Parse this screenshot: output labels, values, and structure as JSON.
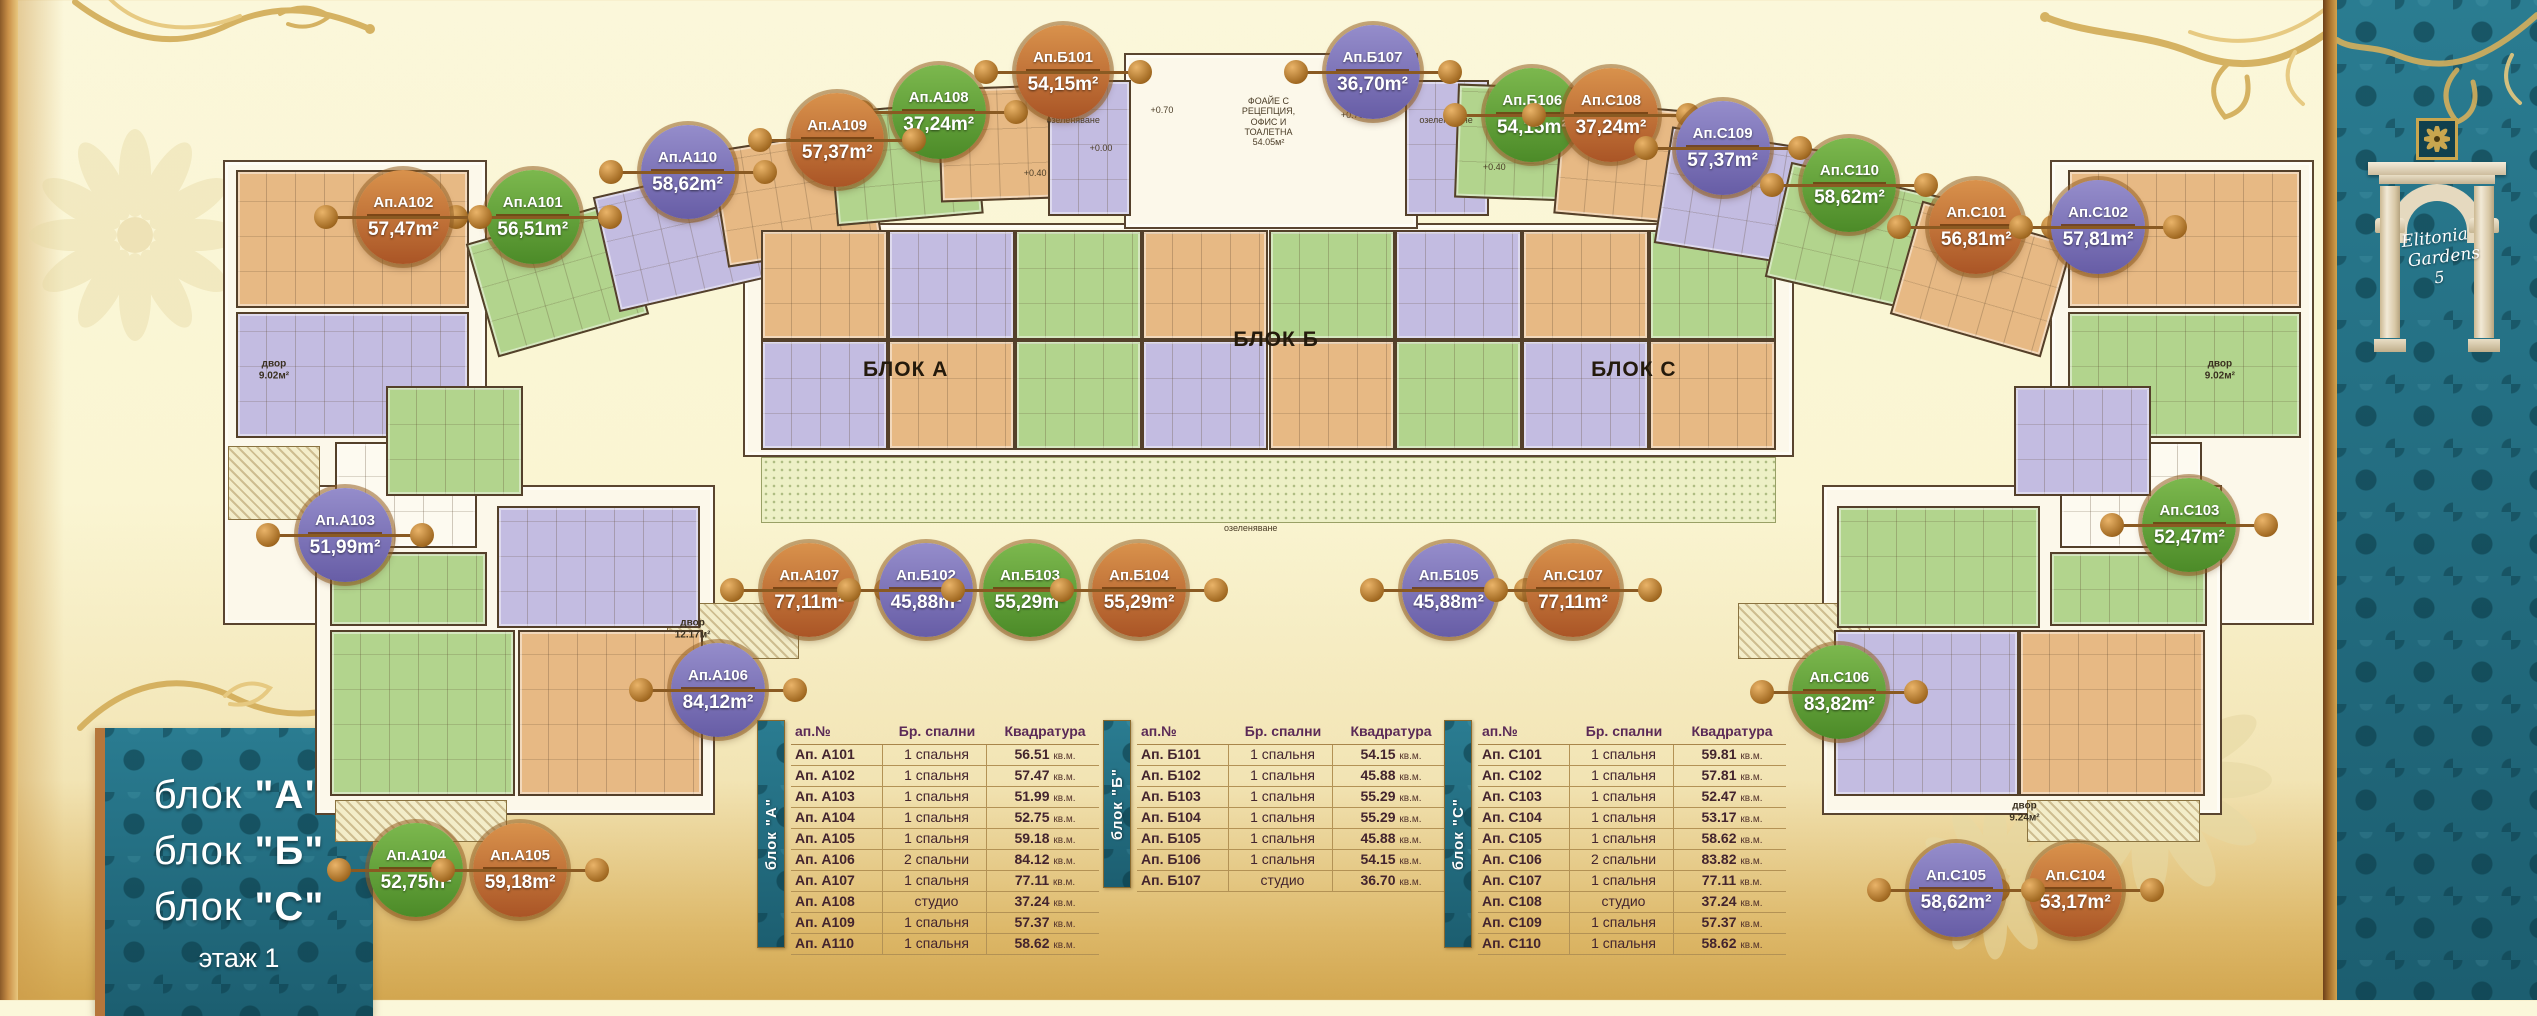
{
  "title_panel": {
    "lines": [
      {
        "prefix": "блок ",
        "letter": "\"А\""
      },
      {
        "prefix": "блок ",
        "letter": "\"Б\""
      },
      {
        "prefix": "блок ",
        "letter": "\"С\""
      }
    ],
    "floor": "этаж 1"
  },
  "brand": {
    "line1": "Elitonia",
    "line2": "Gardens",
    "number": "5"
  },
  "colors": {
    "teal": "#226f83",
    "gold": "#d4af5c",
    "cream": "#fbf7da",
    "badge_orange": "#c4702f",
    "badge_green": "#5f9a35",
    "badge_purple": "#7d74b5"
  },
  "plan": {
    "bases": [
      [
        8.8,
        16.0,
        10.4,
        46.5
      ],
      [
        12.4,
        48.5,
        15.8,
        33.0
      ],
      [
        29.3,
        22.3,
        41.4,
        23.4
      ],
      [
        44.3,
        5.3,
        11.6,
        17.6
      ],
      [
        80.8,
        16.0,
        10.4,
        46.5
      ],
      [
        71.8,
        48.5,
        15.8,
        33.0
      ]
    ],
    "cells": [
      [
        9.3,
        17.0,
        9.2,
        13.8,
        "orange",
        0
      ],
      [
        9.3,
        31.2,
        9.2,
        12.6,
        "purple",
        0
      ],
      [
        13.2,
        44.2,
        5.6,
        10.6,
        "white",
        0
      ],
      [
        13.0,
        55.2,
        6.2,
        7.4,
        "green",
        0
      ],
      [
        13.0,
        63.0,
        7.3,
        16.6,
        "green",
        0
      ],
      [
        20.4,
        63.0,
        7.3,
        16.6,
        "orange",
        0
      ],
      [
        19.6,
        50.6,
        8.0,
        12.2,
        "purple",
        0
      ],
      [
        15.2,
        38.6,
        5.4,
        11.0,
        "green",
        0
      ],
      [
        18.9,
        22.0,
        6.2,
        11.8,
        "green",
        -16
      ],
      [
        23.8,
        17.8,
        6.2,
        11.8,
        "purple",
        -13
      ],
      [
        28.3,
        13.8,
        6.2,
        11.8,
        "orange",
        -9
      ],
      [
        32.8,
        10.6,
        5.8,
        11.4,
        "green",
        -5
      ],
      [
        37.0,
        8.6,
        5.6,
        11.4,
        "orange",
        -2
      ],
      [
        41.3,
        8.0,
        3.3,
        13.6,
        "purple",
        0
      ],
      [
        55.4,
        8.0,
        3.3,
        13.6,
        "purple",
        0
      ],
      [
        30.0,
        23.0,
        5.0,
        11.0,
        "orange",
        0
      ],
      [
        35.0,
        23.0,
        5.0,
        11.0,
        "purple",
        0
      ],
      [
        40.0,
        23.0,
        5.0,
        11.0,
        "green",
        0
      ],
      [
        45.0,
        23.0,
        5.0,
        11.0,
        "orange",
        0
      ],
      [
        50.0,
        23.0,
        5.0,
        11.0,
        "green",
        0
      ],
      [
        55.0,
        23.0,
        5.0,
        11.0,
        "purple",
        0
      ],
      [
        60.0,
        23.0,
        5.0,
        11.0,
        "orange",
        0
      ],
      [
        65.0,
        23.0,
        5.0,
        11.0,
        "green",
        0
      ],
      [
        30.0,
        34.0,
        5.0,
        11.0,
        "purple",
        0
      ],
      [
        35.0,
        34.0,
        5.0,
        11.0,
        "orange",
        0
      ],
      [
        40.0,
        34.0,
        5.0,
        11.0,
        "green",
        0
      ],
      [
        45.0,
        34.0,
        5.0,
        11.0,
        "purple",
        0
      ],
      [
        50.0,
        34.0,
        5.0,
        11.0,
        "orange",
        0
      ],
      [
        55.0,
        34.0,
        5.0,
        11.0,
        "green",
        0
      ],
      [
        60.0,
        34.0,
        5.0,
        11.0,
        "purple",
        0
      ],
      [
        65.0,
        34.0,
        5.0,
        11.0,
        "orange",
        0
      ],
      [
        57.4,
        8.6,
        5.6,
        11.4,
        "green",
        2
      ],
      [
        61.4,
        10.6,
        5.8,
        11.4,
        "orange",
        5
      ],
      [
        65.5,
        13.8,
        6.2,
        11.8,
        "purple",
        9
      ],
      [
        70.0,
        17.8,
        6.2,
        11.8,
        "green",
        13
      ],
      [
        75.0,
        22.0,
        6.2,
        11.8,
        "orange",
        16
      ],
      [
        81.5,
        17.0,
        9.2,
        13.8,
        "orange",
        0
      ],
      [
        81.5,
        31.2,
        9.2,
        12.6,
        "green",
        0
      ],
      [
        81.2,
        44.2,
        5.6,
        10.6,
        "white",
        0
      ],
      [
        80.8,
        55.2,
        6.2,
        7.4,
        "green",
        0
      ],
      [
        72.4,
        50.6,
        8.0,
        12.2,
        "green",
        0
      ],
      [
        72.3,
        63.0,
        7.3,
        16.6,
        "purple",
        0
      ],
      [
        79.6,
        63.0,
        7.3,
        16.6,
        "orange",
        0
      ],
      [
        79.4,
        38.6,
        5.4,
        11.0,
        "purple",
        0
      ]
    ],
    "hatches": [
      [
        30.0,
        45.7,
        40.0,
        6.6,
        "dot"
      ],
      [
        37.2,
        9.6,
        7.4,
        3.4,
        "dot"
      ],
      [
        55.4,
        9.6,
        7.4,
        3.4,
        "dot"
      ],
      [
        9.0,
        44.6,
        3.6,
        7.4,
        "line"
      ],
      [
        13.2,
        80.0,
        6.8,
        4.2,
        "line"
      ],
      [
        79.9,
        80.0,
        6.8,
        4.2,
        "line"
      ],
      [
        26.3,
        60.3,
        5.2,
        5.6,
        "line"
      ],
      [
        68.5,
        60.3,
        5.2,
        5.6,
        "line"
      ]
    ],
    "labels": [
      {
        "text": "БЛОК А",
        "x": 35.7,
        "y": 37.0,
        "cls": "lg"
      },
      {
        "text": "БЛОК Б",
        "x": 50.3,
        "y": 34.0,
        "cls": "lg"
      },
      {
        "text": "БЛОК С",
        "x": 64.4,
        "y": 37.0,
        "cls": "lg"
      },
      {
        "text": "ФОАЙЕ С\nРЕЦЕПЦИЯ,\nОФИС И\nТОАЛЕТНА\n54.05м²",
        "x": 50.0,
        "y": 12.2,
        "cls": "xs"
      },
      {
        "text": "озеленяване",
        "x": 42.3,
        "y": 12.0,
        "cls": "xs"
      },
      {
        "text": "озеленяване",
        "x": 57.0,
        "y": 12.0,
        "cls": "xs"
      },
      {
        "text": "озеленяване",
        "x": 49.3,
        "y": 52.8,
        "cls": "xs"
      },
      {
        "text": "двор\n9.02м²",
        "x": 10.8,
        "y": 37.0,
        "cls": "sm"
      },
      {
        "text": "двор\n12.17м²",
        "x": 27.3,
        "y": 62.9,
        "cls": "sm"
      },
      {
        "text": "двор\n9.24м²",
        "x": 79.8,
        "y": 81.2,
        "cls": "sm"
      },
      {
        "text": "двор\n9.02м²",
        "x": 87.5,
        "y": 37.0,
        "cls": "sm"
      },
      {
        "text": "+0.70",
        "x": 45.8,
        "y": 11.0,
        "cls": "xs"
      },
      {
        "text": "+0.00",
        "x": 43.4,
        "y": 14.8,
        "cls": "xs"
      },
      {
        "text": "+0.40",
        "x": 40.8,
        "y": 17.3,
        "cls": "xs"
      },
      {
        "text": "+0.70",
        "x": 53.3,
        "y": 11.5,
        "cls": "xs"
      },
      {
        "text": "+0.40",
        "x": 58.9,
        "y": 16.7,
        "cls": "xs"
      }
    ]
  },
  "badges": [
    {
      "label": "Ап.А101",
      "area": "56,51m²",
      "color": "green",
      "x": 21.0,
      "y": 21.7
    },
    {
      "label": "Ап.А102",
      "area": "57,47m²",
      "color": "orange",
      "x": 15.9,
      "y": 21.7
    },
    {
      "label": "Ап.А103",
      "area": "51,99m²",
      "color": "purple",
      "x": 13.6,
      "y": 53.5
    },
    {
      "label": "Ап.А104",
      "area": "52,75m²",
      "color": "green",
      "x": 16.4,
      "y": 87.0
    },
    {
      "label": "Ап.А105",
      "area": "59,18m²",
      "color": "orange",
      "x": 20.5,
      "y": 87.0
    },
    {
      "label": "Ап.А106",
      "area": "84,12m²",
      "color": "purple",
      "x": 28.3,
      "y": 69.0
    },
    {
      "label": "Ап.А107",
      "area": "77,11m²",
      "color": "orange",
      "x": 31.9,
      "y": 59.0
    },
    {
      "label": "Ап.А108",
      "area": "37,24m²",
      "color": "green",
      "x": 37.0,
      "y": 11.2
    },
    {
      "label": "Ап.А109",
      "area": "57,37m²",
      "color": "orange",
      "x": 33.0,
      "y": 14.0
    },
    {
      "label": "Ап.А110",
      "area": "58,62m²",
      "color": "purple",
      "x": 27.1,
      "y": 17.2
    },
    {
      "label": "Ап.Б101",
      "area": "54,15m²",
      "color": "orange",
      "x": 41.9,
      "y": 7.2
    },
    {
      "label": "Ап.Б102",
      "area": "45,88m²",
      "color": "purple",
      "x": 36.5,
      "y": 59.0
    },
    {
      "label": "Ап.Б103",
      "area": "55,29m²",
      "color": "green",
      "x": 40.6,
      "y": 59.0
    },
    {
      "label": "Ап.Б104",
      "area": "55,29m²",
      "color": "orange",
      "x": 44.9,
      "y": 59.0
    },
    {
      "label": "Ап.Б105",
      "area": "45,88m²",
      "color": "purple",
      "x": 57.1,
      "y": 59.0
    },
    {
      "label": "Ап.Б106",
      "area": "54,15m²",
      "color": "green",
      "x": 60.4,
      "y": 11.5
    },
    {
      "label": "Ап.Б107",
      "area": "36,70m²",
      "color": "purple",
      "x": 54.1,
      "y": 7.2
    },
    {
      "label": "Ап.C101",
      "area": "56,81m²",
      "color": "orange",
      "x": 77.9,
      "y": 22.7
    },
    {
      "label": "Ап.C102",
      "area": "57,81m²",
      "color": "purple",
      "x": 82.7,
      "y": 22.7
    },
    {
      "label": "Ап.C103",
      "area": "52,47m²",
      "color": "green",
      "x": 86.3,
      "y": 52.5
    },
    {
      "label": "Ап.C104",
      "area": "53,17m²",
      "color": "orange",
      "x": 81.8,
      "y": 89.0
    },
    {
      "label": "Ап.C105",
      "area": "58,62m²",
      "color": "purple",
      "x": 77.1,
      "y": 89.0
    },
    {
      "label": "Ап.C106",
      "area": "83,82m²",
      "color": "green",
      "x": 72.5,
      "y": 69.2
    },
    {
      "label": "Ап.C107",
      "area": "77,11m²",
      "color": "orange",
      "x": 62.0,
      "y": 59.0
    },
    {
      "label": "Ап.C108",
      "area": "37,24m²",
      "color": "orange",
      "x": 63.5,
      "y": 11.5
    },
    {
      "label": "Ап.C109",
      "area": "57,37m²",
      "color": "purple",
      "x": 67.9,
      "y": 14.8
    },
    {
      "label": "Ап.C110",
      "area": "58,62m²",
      "color": "green",
      "x": 72.9,
      "y": 18.5
    }
  ],
  "tables": [
    {
      "id": "A",
      "strip": "блок \"А\"",
      "x": 757,
      "y": 720,
      "headers": [
        "ап.№",
        "Бр. спални",
        "Квадратура"
      ],
      "rows": [
        {
          "apt": "Ап. А101",
          "bed": "1 спальня",
          "area": "56.51",
          "unit": "кв.м."
        },
        {
          "apt": "Ап. А102",
          "bed": "1 спальня",
          "area": "57.47",
          "unit": "кв.м."
        },
        {
          "apt": "Ап. А103",
          "bed": "1 спальня",
          "area": "51.99",
          "unit": "кв.м."
        },
        {
          "apt": "Ап. А104",
          "bed": "1 спальня",
          "area": "52.75",
          "unit": "кв.м."
        },
        {
          "apt": "Ап. А105",
          "bed": "1 спальня",
          "area": "59.18",
          "unit": "кв.м."
        },
        {
          "apt": "Ап. А106",
          "bed": "2 спальни",
          "area": "84.12",
          "unit": "кв.м."
        },
        {
          "apt": "Ап. А107",
          "bed": "1 спальня",
          "area": "77.11",
          "unit": "кв.м."
        },
        {
          "apt": "Ап. А108",
          "bed": "студио",
          "area": "37.24",
          "unit": "кв.м."
        },
        {
          "apt": "Ап. А109",
          "bed": "1 спальня",
          "area": "57.37",
          "unit": "кв.м."
        },
        {
          "apt": "Ап. А110",
          "bed": "1 спальня",
          "area": "58.62",
          "unit": "кв.м."
        }
      ]
    },
    {
      "id": "B",
      "strip": "блок \"Б\"",
      "x": 1103,
      "y": 720,
      "headers": [
        "ап.№",
        "Бр. спални",
        "Квадратура"
      ],
      "rows": [
        {
          "apt": "Ап. Б101",
          "bed": "1 спальня",
          "area": "54.15",
          "unit": "кв.м."
        },
        {
          "apt": "Ап. Б102",
          "bed": "1 спальня",
          "area": "45.88",
          "unit": "кв.м."
        },
        {
          "apt": "Ап. Б103",
          "bed": "1 спальня",
          "area": "55.29",
          "unit": "кв.м."
        },
        {
          "apt": "Ап. Б104",
          "bed": "1 спальня",
          "area": "55.29",
          "unit": "кв.м."
        },
        {
          "apt": "Ап. Б105",
          "bed": "1 спальня",
          "area": "45.88",
          "unit": "кв.м."
        },
        {
          "apt": "Ап. Б106",
          "bed": "1 спальня",
          "area": "54.15",
          "unit": "кв.м."
        },
        {
          "apt": "Ап. Б107",
          "bed": "студио",
          "area": "36.70",
          "unit": "кв.м."
        }
      ]
    },
    {
      "id": "C",
      "strip": "блок \"С\"",
      "x": 1444,
      "y": 720,
      "headers": [
        "ап.№",
        "Бр. спални",
        "Квадратура"
      ],
      "rows": [
        {
          "apt": "Ап. C101",
          "bed": "1 спальня",
          "area": "59.81",
          "unit": "кв.м."
        },
        {
          "apt": "Ап. C102",
          "bed": "1 спальня",
          "area": "57.81",
          "unit": "кв.м."
        },
        {
          "apt": "Ап. C103",
          "bed": "1 спальня",
          "area": "52.47",
          "unit": "кв.м."
        },
        {
          "apt": "Ап. C104",
          "bed": "1 спальня",
          "area": "53.17",
          "unit": "кв.м."
        },
        {
          "apt": "Ап. C105",
          "bed": "1 спальня",
          "area": "58.62",
          "unit": "кв.м."
        },
        {
          "apt": "Ап. C106",
          "bed": "2 спальни",
          "area": "83.82",
          "unit": "кв.м."
        },
        {
          "apt": "Ап. C107",
          "bed": "1 спальня",
          "area": "77.11",
          "unit": "кв.м."
        },
        {
          "apt": "Ап. C108",
          "bed": "студио",
          "area": "37.24",
          "unit": "кв.м."
        },
        {
          "apt": "Ап. C109",
          "bed": "1 спальня",
          "area": "57.37",
          "unit": "кв.м."
        },
        {
          "apt": "Ап. C110",
          "bed": "1 спальня",
          "area": "58.62",
          "unit": "кв.м."
        }
      ]
    }
  ]
}
